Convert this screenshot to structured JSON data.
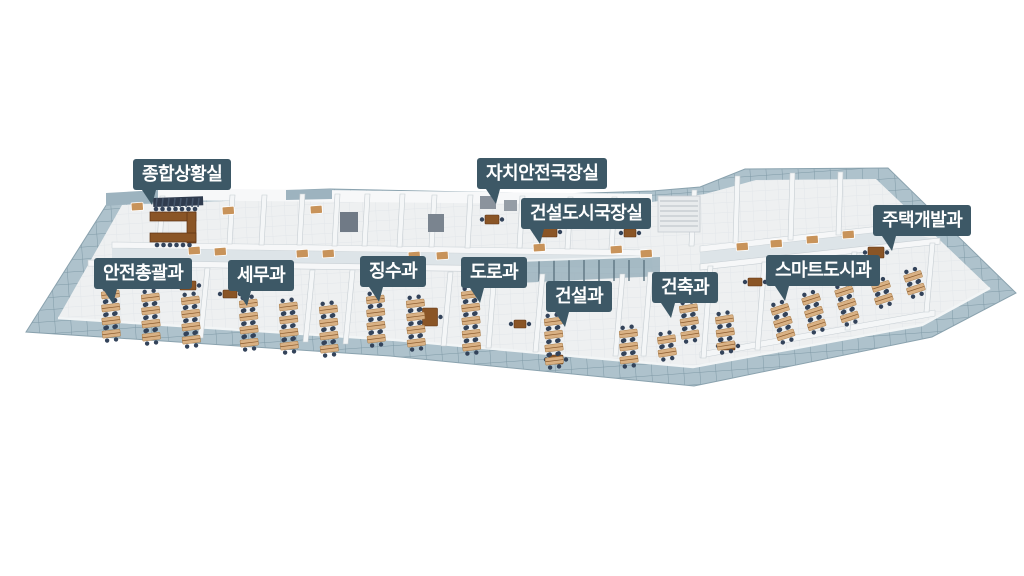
{
  "scene": {
    "description": "3D isometric office floorplan with room name markers",
    "background": "#ffffff"
  },
  "palette": {
    "label_bg": "#3d5866",
    "label_text": "#ffffff",
    "glass_wall": "#aec2cc",
    "glass_grid": "#7f99a6",
    "floor": "#eef0f1",
    "interior_wall": "#f4f6f7",
    "desk_wood": "#d9b184",
    "desk_brown": "#7d4a22",
    "chair": "#33435a"
  },
  "labels": [
    {
      "id": "jonghap-sanghwangsil",
      "text": "종합상황실",
      "x": 133,
      "y": 159
    },
    {
      "id": "jachi-anjeon-gukjangsil",
      "text": "자치안전국장실",
      "x": 477,
      "y": 158
    },
    {
      "id": "geonseol-dosi-gukjangsil",
      "text": "건설도시국장실",
      "x": 521,
      "y": 198
    },
    {
      "id": "jutaek-gaebalgwa",
      "text": "주택개발과",
      "x": 873,
      "y": 205
    },
    {
      "id": "anjeon-chonggwalgwa",
      "text": "안전총괄과",
      "x": 94,
      "y": 258
    },
    {
      "id": "semugwa",
      "text": "세무과",
      "x": 228,
      "y": 260
    },
    {
      "id": "jingsugwa",
      "text": "징수과",
      "x": 360,
      "y": 256
    },
    {
      "id": "dorogwa",
      "text": "도로과",
      "x": 461,
      "y": 257
    },
    {
      "id": "geonseolgwa",
      "text": "건설과",
      "x": 546,
      "y": 281
    },
    {
      "id": "geonchukgwa",
      "text": "건축과",
      "x": 652,
      "y": 272
    },
    {
      "id": "smart-dosigwa",
      "text": "스마트도시과",
      "x": 766,
      "y": 255
    }
  ]
}
